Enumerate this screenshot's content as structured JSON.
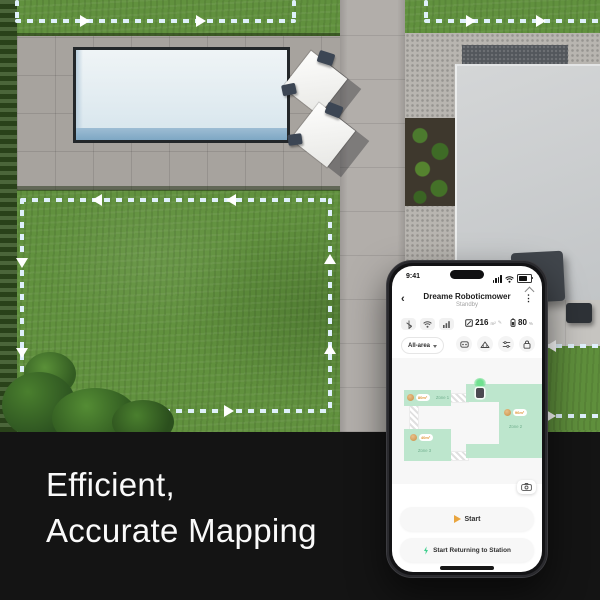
{
  "headline": {
    "line1": "Efficient,",
    "line2": "Accurate Mapping"
  },
  "phone": {
    "status_bar": {
      "time": "9:41"
    },
    "icons": {
      "back": "‹",
      "menu": "⋮",
      "edit": "✎"
    },
    "header": {
      "title": "Dreame Roboticmower",
      "subtitle": "Standby"
    },
    "stats": {
      "area": {
        "value": "216",
        "unit": "m²"
      },
      "battery": {
        "value": "80",
        "unit": "%"
      }
    },
    "toolbar": {
      "area_selector_label": "All-area",
      "buttons": [
        {
          "name": "remote-control"
        },
        {
          "name": "mow-zones"
        },
        {
          "name": "settings-sliders"
        },
        {
          "name": "lock"
        }
      ]
    },
    "map": {
      "zones": [
        {
          "label": "Zone 1",
          "area": "80m²"
        },
        {
          "label": "Zone 2",
          "area": "96m²"
        },
        {
          "label": "Zone 3",
          "area": "40m²"
        }
      ]
    },
    "actions": {
      "start": "Start",
      "return_to_station": "Start Returning to Station"
    }
  },
  "scene": {
    "colors": {
      "dash": "#dff0fb",
      "zone_fill": "#bde6cd",
      "accent_orange": "#e9a53f",
      "accent_green": "#3ecf8e",
      "band": "#141414"
    }
  }
}
